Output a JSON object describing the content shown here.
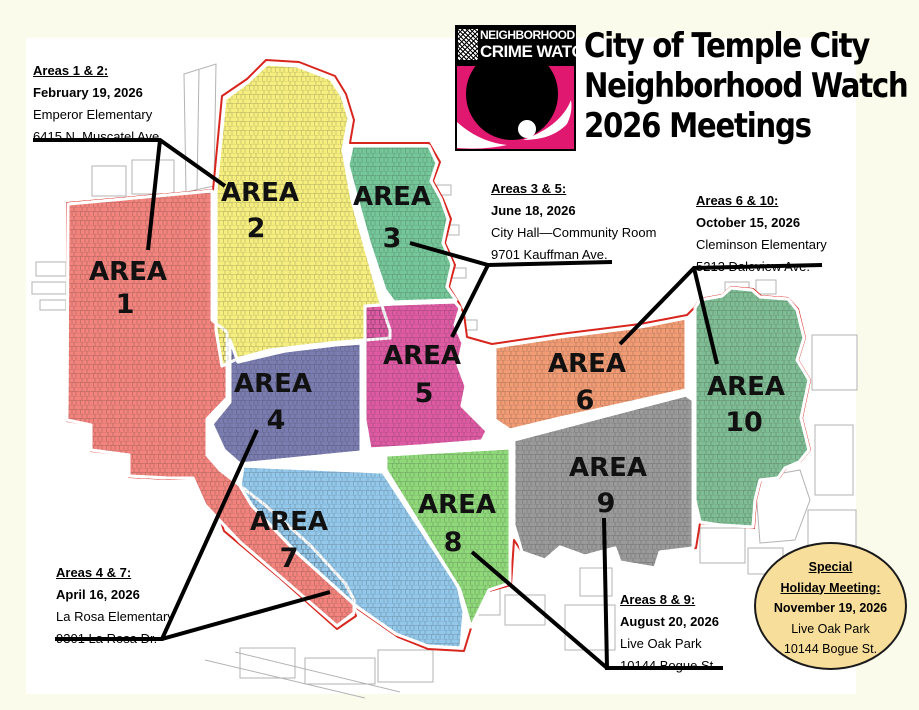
{
  "page": {
    "background": "#FAFBEA",
    "canvas": "#FFFFFF"
  },
  "logo": {
    "top_line": "NEIGHBORHOOD",
    "bottom_line": "CRIME WATCH",
    "pink": "#E0186F"
  },
  "title": {
    "line1": "City of Temple City",
    "line2": "Neighborhood Watch",
    "line3": "2026 Meetings"
  },
  "annotations": {
    "areas_1_2": {
      "heading": "Areas 1 & 2:",
      "date": "February 19, 2026",
      "location": "Emperor Elementary",
      "address": "6415 N. Muscatel Ave."
    },
    "areas_3_5": {
      "heading": "Areas 3 & 5:",
      "date": "June 18, 2026",
      "location": "City Hall—Community Room",
      "address": "9701 Kauffman Ave."
    },
    "areas_6_10": {
      "heading": "Areas 6 & 10:",
      "date": "October 15, 2026",
      "location": "Cleminson Elementary",
      "address": "5213 Daleview Ave."
    },
    "areas_4_7": {
      "heading": "Areas 4 & 7:",
      "date": "April 16, 2026",
      "location": "La Rosa Elementary",
      "address": "9301 La Rosa Dr."
    },
    "areas_8_9": {
      "heading": "Areas 8 & 9:",
      "date": "August 20, 2026",
      "location": "Live Oak Park",
      "address": "10144 Bogue St."
    }
  },
  "special_meeting": {
    "heading_line1": "Special",
    "heading_line2": "Holiday Meeting:",
    "date": "November 19, 2026",
    "location": "Live Oak Park",
    "address": "10144 Bogue St.",
    "fill": "#F8DE9B"
  },
  "map": {
    "boundary_color": "#D8251D",
    "areas": [
      {
        "label": "AREA",
        "number": "1",
        "color": "#F2837D"
      },
      {
        "label": "AREA",
        "number": "2",
        "color": "#F6EF7F"
      },
      {
        "label": "AREA",
        "number": "3",
        "color": "#75C79A"
      },
      {
        "label": "AREA",
        "number": "4",
        "color": "#7B7DB1"
      },
      {
        "label": "AREA",
        "number": "5",
        "color": "#DE5BA4"
      },
      {
        "label": "AREA",
        "number": "6",
        "color": "#F19C74"
      },
      {
        "label": "AREA",
        "number": "7",
        "color": "#93C8EB"
      },
      {
        "label": "AREA",
        "number": "8",
        "color": "#90D97B"
      },
      {
        "label": "AREA",
        "number": "9",
        "color": "#9A9A9A"
      },
      {
        "label": "AREA",
        "number": "10",
        "color": "#7FBD94"
      }
    ]
  }
}
